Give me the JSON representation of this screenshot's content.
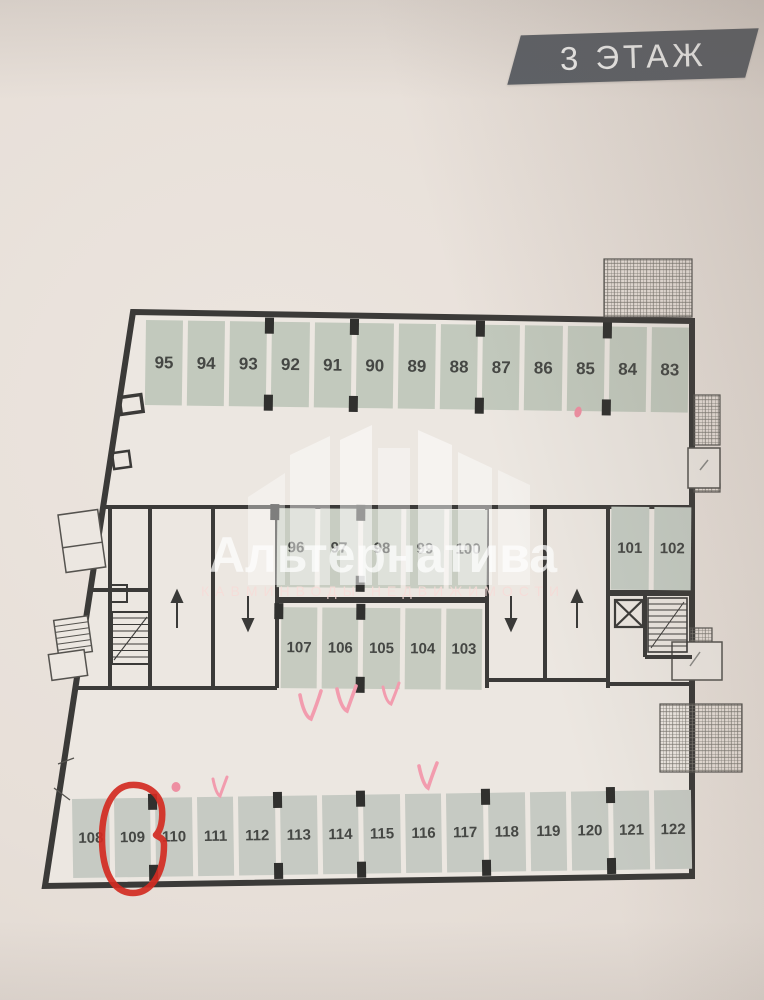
{
  "page": {
    "floor_badge": "3 ЭТАЖ"
  },
  "watermark": {
    "brand": "Альтернатива",
    "tagline": "КАВМИНВОДЫ НЕДВИЖИМОСТИ",
    "logo": "building-skyline-icon"
  },
  "floor_plan": {
    "rows": {
      "top": {
        "units": [
          "95",
          "94",
          "93",
          "92",
          "91",
          "90",
          "89",
          "88",
          "87",
          "86",
          "85",
          "84",
          "83"
        ]
      },
      "middle": {
        "units": [
          "96",
          "97",
          "98",
          "99",
          "100"
        ]
      },
      "middle_right": {
        "units": [
          "101",
          "102"
        ]
      },
      "lower_middle": {
        "units": [
          "107",
          "106",
          "105",
          "104",
          "103"
        ]
      },
      "bottom": {
        "units": [
          "108",
          "109",
          "110",
          "111",
          "112",
          "113",
          "114",
          "115",
          "116",
          "117",
          "118",
          "119",
          "120",
          "121",
          "122"
        ]
      }
    },
    "symbols": {
      "ramp_arrows": [
        "up-arrow",
        "down-arrow",
        "down-arrow",
        "up-arrow"
      ],
      "elevator": "x-box-icon",
      "stairs": "stair-treads-icon",
      "balconies": "crosshatch-areas"
    }
  },
  "annotations": {
    "red_circle_unit": "109",
    "pink_checkmarks_near": [
      "107",
      "106",
      "105",
      "111",
      "116"
    ],
    "pink_dots_near": [
      "85",
      "110"
    ]
  },
  "colors": {
    "paper": "#e7dfd8",
    "plan_fill": "#ece7e1",
    "wall": "#3b3a38",
    "unit_fill": "#c4cabf",
    "unit_number": "#454744",
    "banner_bg": "#5d6167",
    "banner_text": "#f3f3f2",
    "marker_red": "#d22b22",
    "marker_pink": "#f29cae"
  }
}
